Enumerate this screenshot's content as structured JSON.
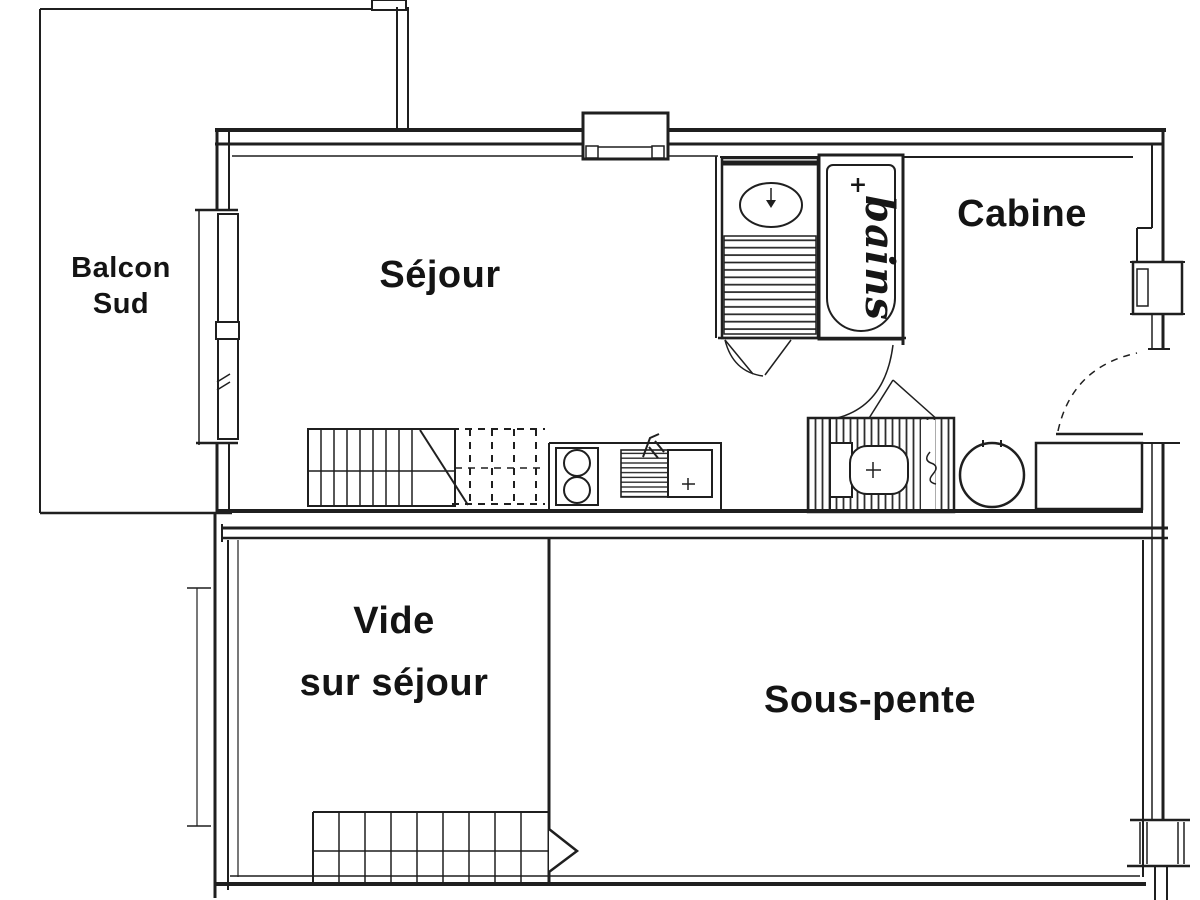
{
  "document": {
    "kind": "apartment floor plan drawing"
  },
  "colors": {
    "paper": "#ffffff",
    "ink": "#1f1f1f"
  },
  "labels": {
    "balcony_line1": "Balcon",
    "balcony_line2": "Sud",
    "living_room": "Séjour",
    "cabin": "Cabine",
    "bath_script": "bains",
    "bath_plus": "+",
    "void_line1": "Vide",
    "void_line2": "sur séjour",
    "under_slope": "Sous-pente"
  }
}
